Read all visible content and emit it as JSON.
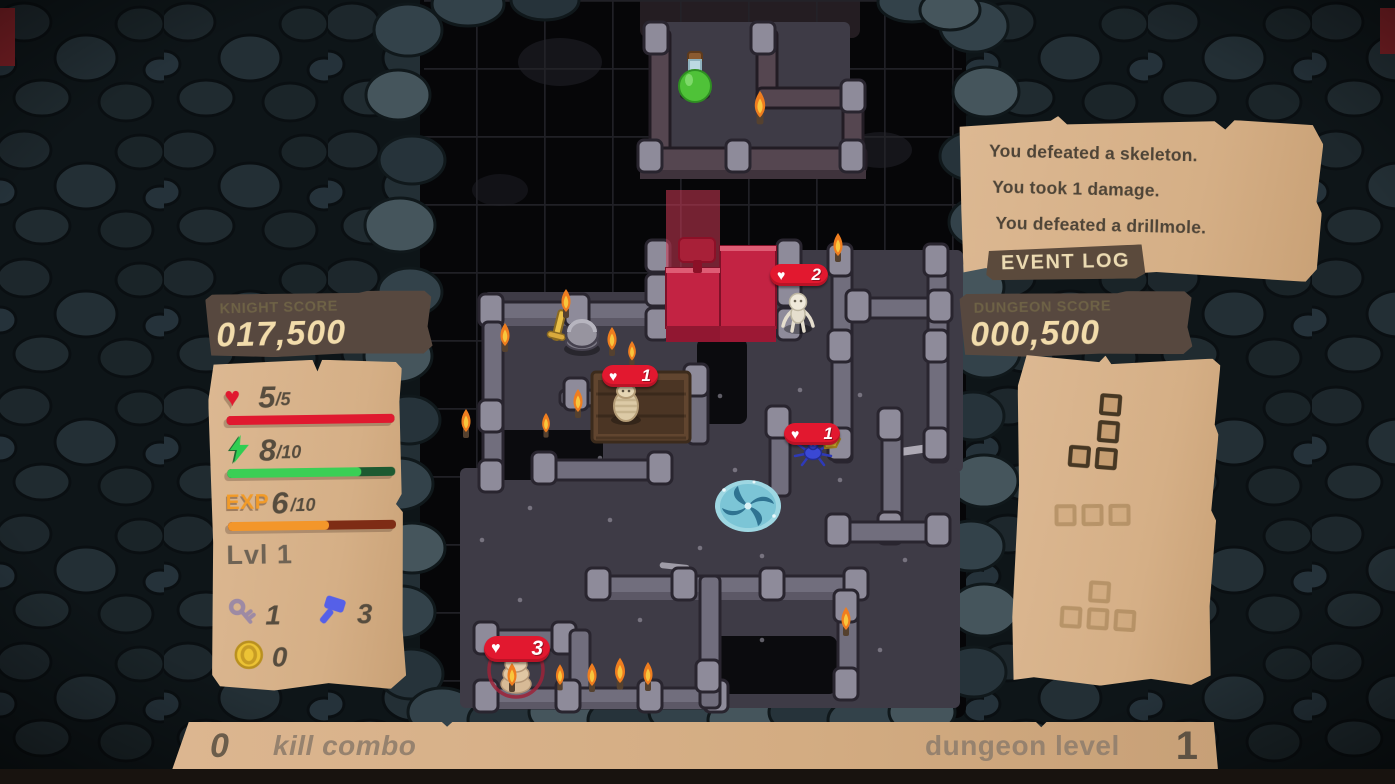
{
  "colors": {
    "parchment": "#d7b28a",
    "banner_brown": "#57483f",
    "banner_label": "#6e6246",
    "banner_value": "#f2dcab",
    "health_red": "#e0192f",
    "energy_green": "#3bcf55",
    "energy_track": "#1d5a31",
    "exp_orange": "#f3962a",
    "exp_track": "#7e2c15",
    "piece_red": "#c32343",
    "portal_teal": "#7cc5d6",
    "wall_gray": "#716e7d",
    "floor_gray": "#3e3b46"
  },
  "left": {
    "score_label": "KNIGHT SCORE",
    "score_value": "017,500",
    "hp": {
      "icon": "heart-icon",
      "current": "5",
      "max": "/5",
      "fill_pct": 100
    },
    "energy": {
      "icon": "lightning-icon",
      "current": "8",
      "max": "/10",
      "fill_pct": 80
    },
    "exp": {
      "label": "EXP",
      "current": "6",
      "max": "/10",
      "fill_pct": 60
    },
    "level_label": "Lvl 1",
    "keys": "1",
    "hammers": "3",
    "coins": "0"
  },
  "right": {
    "event_log": {
      "entries": [
        "You defeated a skeleton.",
        "You took 1 damage.",
        "You defeated a drillmole."
      ],
      "badge": "EVENT LOG"
    },
    "score_label": "DUNGEON SCORE",
    "score_value": "000,500",
    "queue": [
      {
        "name": "piece-j",
        "faded": false,
        "cells": [
          [
            1,
            0
          ],
          [
            1,
            1
          ],
          [
            0,
            2
          ],
          [
            1,
            2
          ]
        ]
      },
      {
        "name": "piece-i3",
        "faded": true,
        "cells": [
          [
            0,
            0
          ],
          [
            1,
            0
          ],
          [
            2,
            0
          ]
        ]
      },
      {
        "name": "piece-t",
        "faded": true,
        "cells": [
          [
            1,
            0
          ],
          [
            0,
            1
          ],
          [
            1,
            1
          ],
          [
            2,
            1
          ]
        ]
      }
    ]
  },
  "bottom": {
    "combo_value": "0",
    "combo_label": "kill combo",
    "level_label": "dungeon level",
    "level_value": "1"
  },
  "board": {
    "player": {
      "name": "knight"
    },
    "enemies": [
      {
        "name": "skeleton",
        "hp": "2"
      },
      {
        "name": "drillmole",
        "hp": "1"
      },
      {
        "name": "spider",
        "hp": "1"
      },
      {
        "name": "worm",
        "hp": "3"
      }
    ],
    "items": [
      {
        "name": "potion"
      },
      {
        "name": "portal"
      },
      {
        "name": "gold-nugget"
      }
    ]
  }
}
